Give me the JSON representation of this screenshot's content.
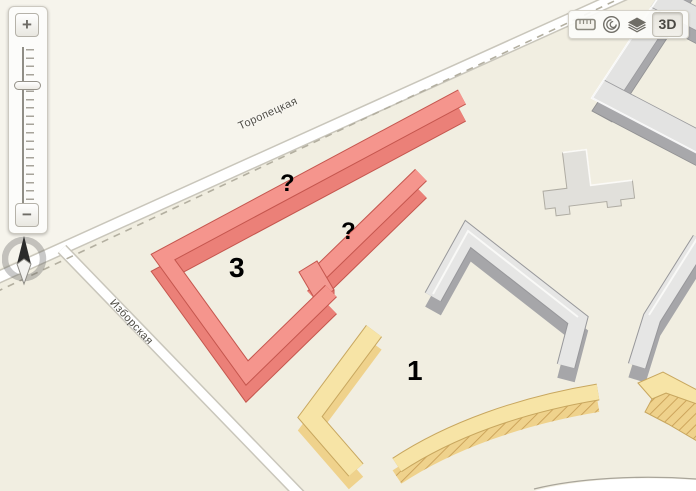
{
  "toolbar": {
    "icons": [
      {
        "name": "ruler-icon"
      },
      {
        "name": "mirrors-icon"
      },
      {
        "name": "layers-icon"
      }
    ],
    "button_3d_label": "3D",
    "button_3d_active": true
  },
  "zoom_control": {
    "plus_label": "+",
    "minus_label": "−"
  },
  "streets": [
    {
      "name": "Торопецкая"
    },
    {
      "name": "Изборская"
    }
  ],
  "building_labels": [
    {
      "text": "?"
    },
    {
      "text": "?"
    },
    {
      "text": "3"
    },
    {
      "text": "1"
    }
  ],
  "colors": {
    "land": "#F1EEE1",
    "land_far_side": "#F6F4EC",
    "road_fill": "#FFFFFF",
    "road_casing": "#C9C6BB",
    "boundary_dash": "#B3AFA0",
    "building_red_roof": "#F5958D",
    "building_red_side": "#EB8078",
    "building_red_outline": "#C5564E",
    "building_gray_roof": "#E6E6E5",
    "building_gray_side": "#A6A6A9",
    "building_yellow_roof": "#F7E4A6",
    "building_yellow_side": "#EFD28C",
    "building_yellow_outline": "#C8A75F",
    "label_text": "#000000",
    "street_text": "#4F4D45"
  }
}
